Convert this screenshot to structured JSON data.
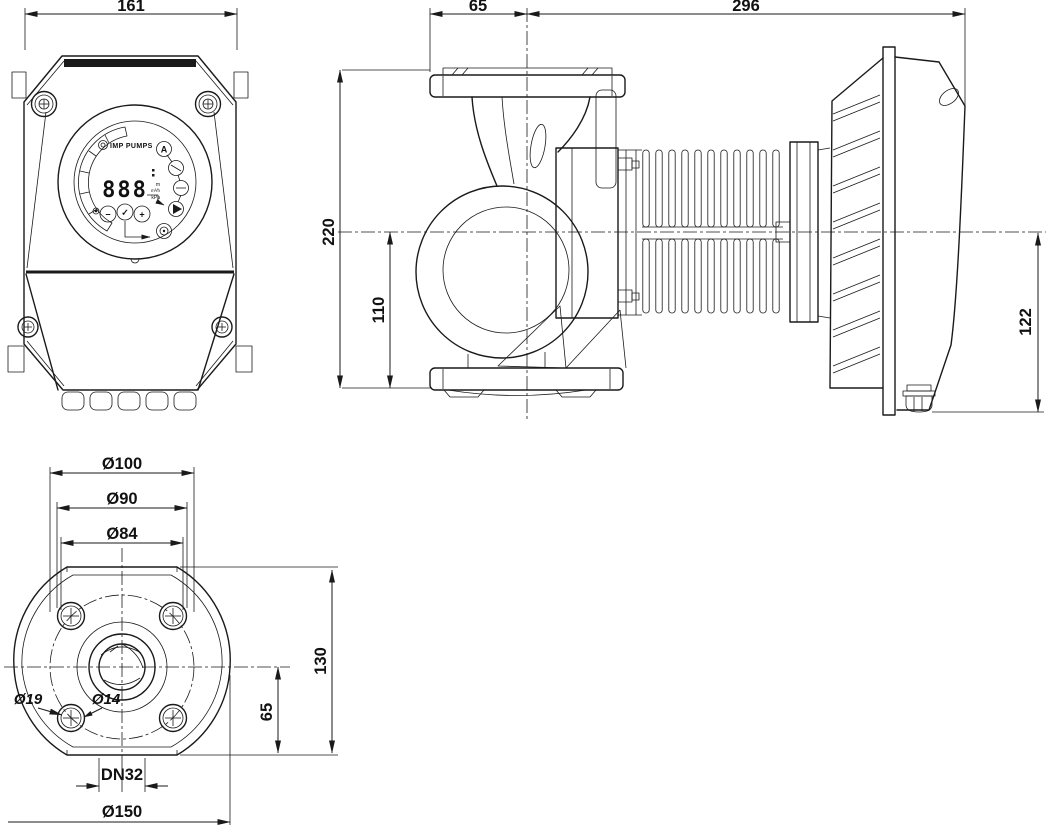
{
  "dims": {
    "front_width": "161",
    "flange_to_axis": "65",
    "axis_to_motor_end": "296",
    "total_height": "220",
    "axis_to_base": "110",
    "axis_to_box_bottom": "122",
    "bolt_flange_od": "Ø100",
    "bolt_circle": "Ø90",
    "hub_circle": "Ø84",
    "bolt_hole_od": "Ø19",
    "bolt_hole_id": "Ø14",
    "nominal_bore": "DN32",
    "flange_od": "Ø150",
    "flange_height": "130",
    "axis_to_flange_edge": "65"
  },
  "panel": {
    "brand": "IMP PUMPS",
    "display_value": "888",
    "display_units": [
      "m",
      "m³/h",
      "kPa"
    ],
    "auto_mode_label": "A",
    "minus_label": "−",
    "ok_label": "✓",
    "plus_label": "+"
  }
}
